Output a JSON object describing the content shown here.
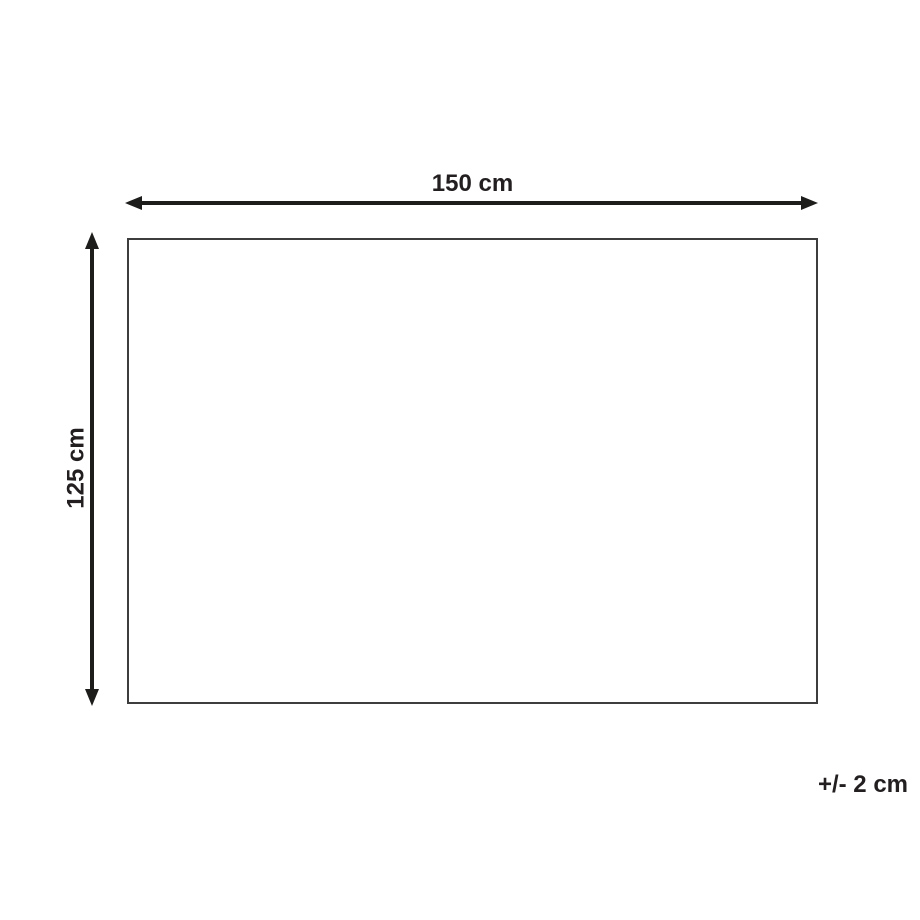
{
  "diagram": {
    "type": "product-dimension-diagram",
    "background_color": "#ffffff",
    "rectangle": {
      "border_color": "#3d3d3d",
      "fill_color": "#ffffff"
    },
    "arrow_color": "#1d1d1b",
    "text_color": "#231f20",
    "width_dimension": {
      "label": "150 cm",
      "value_cm": 150
    },
    "height_dimension": {
      "label": "125 cm",
      "value_cm": 125
    },
    "tolerance": {
      "label": "+/- 2 cm",
      "value_cm": 2
    }
  }
}
